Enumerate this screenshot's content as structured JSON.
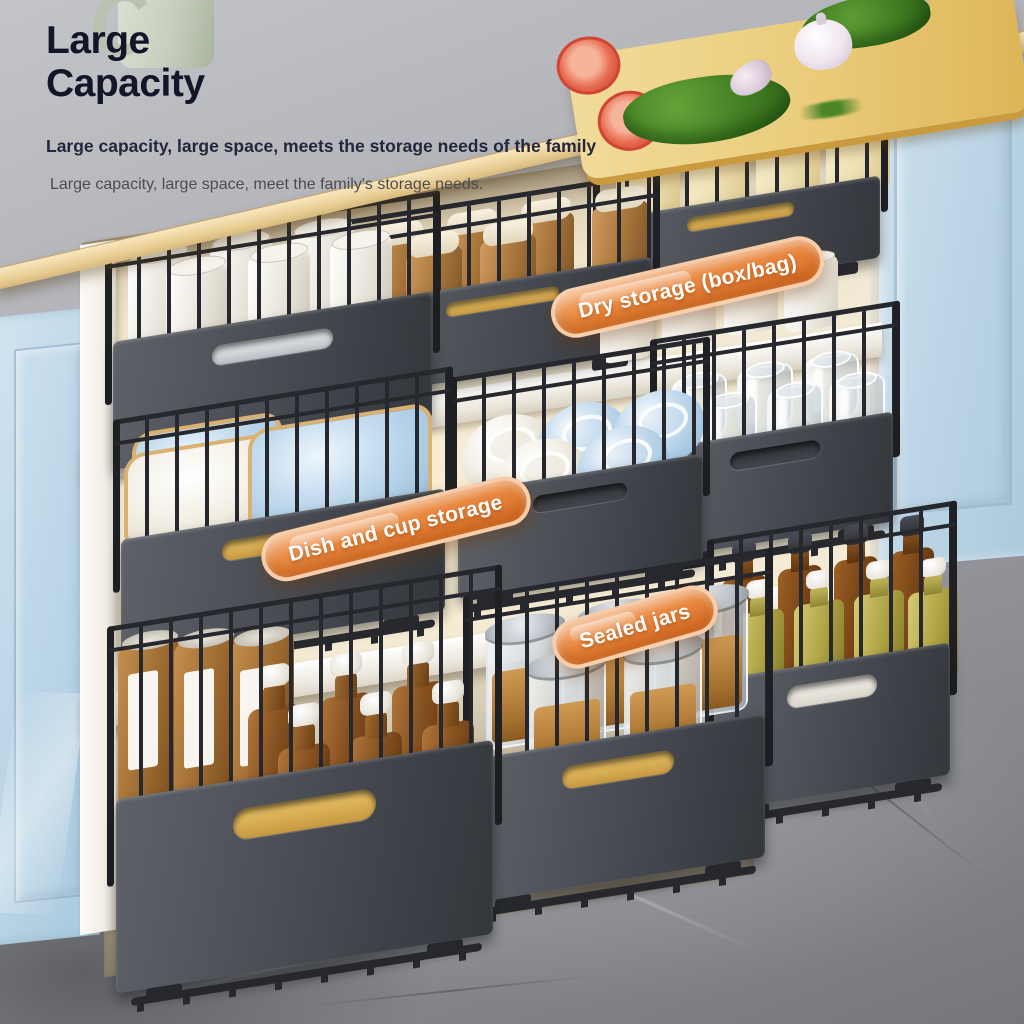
{
  "header": {
    "title": "Large\nCapacity",
    "subtitle": "Large capacity, large space, meets the storage needs of the family",
    "description": "Large capacity, large space, meet the family's storage needs."
  },
  "badges": [
    {
      "label": "Dry storage (box/bag)"
    },
    {
      "label": "Dish and cup storage"
    },
    {
      "label": "Sealed jars"
    }
  ],
  "colors": {
    "title_text": "#15152a",
    "subtitle_text": "#25253c",
    "description_text": "#4d4d4d",
    "badge_orange": "#e8873f",
    "badge_border": "#f8d3b2",
    "badge_text": "#ffffff",
    "cabinet_blue": "#bdd7e8",
    "counter_wood": "#e6c791",
    "basket_charcoal": "#43474d",
    "floor_marble": "#9b9ca1"
  }
}
